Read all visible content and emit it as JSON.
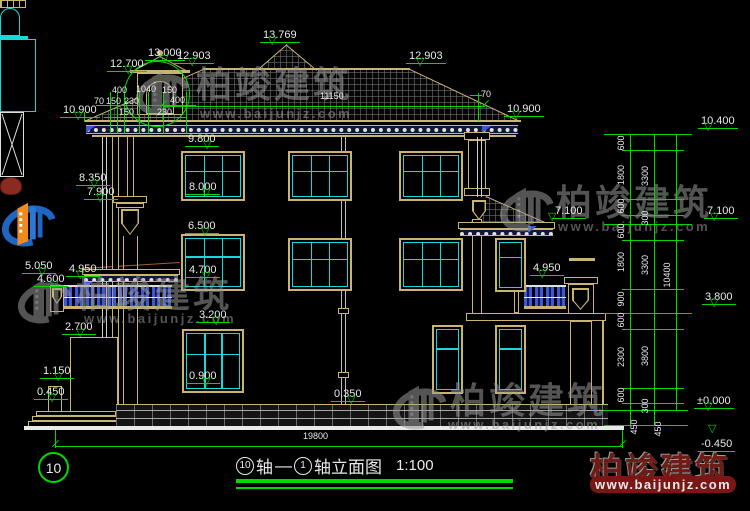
{
  "title_block": {
    "axis_left": "10",
    "axis_word": "轴",
    "dash": "—",
    "axis_right": "1",
    "suffix": "轴立面图",
    "scale": "1:100"
  },
  "watermark": {
    "brand": "柏竣建筑",
    "url": "www.baijunjz.com",
    "gray_color": "#9a9a9a",
    "red_text_color": "#6e1d16",
    "logo_blue": "#1f66c0",
    "logo_orange": "#f08a1f"
  },
  "colors": {
    "background": "#000000",
    "linework_tan": "#c9b472",
    "glazing_cyan": "#1bd8d8",
    "dimension_green": "#00d800",
    "baluster_blue": "#3e57d8",
    "text_white": "#e9e9e9"
  },
  "annotations": {
    "level_markers": [
      {
        "t": "10.900",
        "x": 60,
        "y": 100,
        "tx": 74
      },
      {
        "t": "8.350",
        "x": 76,
        "y": 168,
        "tx": 90
      },
      {
        "t": "7.900",
        "x": 84,
        "y": 182,
        "tx": 96
      },
      {
        "t": "5.050",
        "x": 22,
        "y": 256,
        "tx": 38
      },
      {
        "t": "4.600",
        "x": 34,
        "y": 269,
        "tx": 50
      },
      {
        "t": "4.950",
        "x": 66,
        "y": 259,
        "tx": 76
      },
      {
        "t": "2.700",
        "x": 62,
        "y": 317,
        "tx": 76
      },
      {
        "t": "1.150",
        "x": 40,
        "y": 361,
        "tx": 54
      },
      {
        "t": "0.450",
        "x": 34,
        "y": 382,
        "tx": 48
      },
      {
        "t": "9.800",
        "x": 185,
        "y": 129,
        "tx": 203
      },
      {
        "t": "8.000",
        "x": 186,
        "y": 177,
        "tx": 202
      },
      {
        "t": "6.500",
        "x": 185,
        "y": 216,
        "tx": 201
      },
      {
        "t": "4.700",
        "x": 186,
        "y": 260,
        "tx": 202
      },
      {
        "t": "3.200",
        "x": 196,
        "y": 305,
        "tx": 212
      },
      {
        "t": "0.900",
        "x": 186,
        "y": 366,
        "tx": 202
      },
      {
        "t": "0.350",
        "x": 331,
        "y": 384,
        "tx": 347
      },
      {
        "t": "12.700",
        "x": 107,
        "y": 54,
        "tx": 124
      },
      {
        "t": "13.000",
        "x": 145,
        "y": 43,
        "tx": 160
      },
      {
        "t": "12.903",
        "x": 174,
        "y": 46,
        "tx": 188
      },
      {
        "t": "13.769",
        "x": 260,
        "y": 25,
        "tx": 268
      },
      {
        "t": "12.903",
        "x": 406,
        "y": 46,
        "tx": 416
      },
      {
        "t": "10.900",
        "x": 504,
        "y": 99,
        "tx": 512
      },
      {
        "t": "7.100",
        "x": 552,
        "y": 201,
        "tx": 548
      },
      {
        "t": "4.950",
        "x": 530,
        "y": 258,
        "tx": 538
      },
      {
        "t": "10.400",
        "x": 698,
        "y": 111,
        "tx": 704
      },
      {
        "t": "7.100",
        "x": 704,
        "y": 201,
        "tx": 710
      },
      {
        "t": "3.800",
        "x": 702,
        "y": 287,
        "tx": 710
      },
      {
        "t": "±0.000",
        "x": 694,
        "y": 391,
        "tx": 704
      },
      {
        "t": "-0.450",
        "x": 698,
        "y": 434,
        "tx": 708,
        "flip": true
      }
    ],
    "h_dims": [
      {
        "t": "11150",
        "x": 320,
        "y": 91
      },
      {
        "t": "19800",
        "x": 303,
        "y": 431
      },
      {
        "t": "70",
        "x": 481,
        "y": 89
      },
      {
        "t": "400",
        "x": 112,
        "y": 85
      },
      {
        "t": "1040",
        "x": 136,
        "y": 84
      },
      {
        "t": "150",
        "x": 162,
        "y": 85
      },
      {
        "t": "70",
        "x": 94,
        "y": 96
      },
      {
        "t": "150",
        "x": 106,
        "y": 96
      },
      {
        "t": "230",
        "x": 124,
        "y": 96
      },
      {
        "t": "400",
        "x": 170,
        "y": 95
      },
      {
        "t": "150",
        "x": 119,
        "y": 107
      },
      {
        "t": "230",
        "x": 157,
        "y": 107
      }
    ],
    "v_dims": [
      {
        "t": "600",
        "x": 621,
        "y": 143
      },
      {
        "t": "1800",
        "x": 621,
        "y": 175
      },
      {
        "t": "600",
        "x": 621,
        "y": 206
      },
      {
        "t": "600",
        "x": 621,
        "y": 231
      },
      {
        "t": "1800",
        "x": 621,
        "y": 262
      },
      {
        "t": "900",
        "x": 621,
        "y": 299
      },
      {
        "t": "600",
        "x": 621,
        "y": 320
      },
      {
        "t": "2300",
        "x": 621,
        "y": 357
      },
      {
        "t": "600",
        "x": 621,
        "y": 395
      },
      {
        "t": "450",
        "x": 634,
        "y": 427
      },
      {
        "t": "3300",
        "x": 645,
        "y": 176
      },
      {
        "t": "300",
        "x": 645,
        "y": 218
      },
      {
        "t": "3300",
        "x": 645,
        "y": 265
      },
      {
        "t": "3800",
        "x": 645,
        "y": 356
      },
      {
        "t": "300",
        "x": 645,
        "y": 406
      },
      {
        "t": "450",
        "x": 658,
        "y": 429
      },
      {
        "t": "10400",
        "x": 667,
        "y": 275
      }
    ]
  }
}
